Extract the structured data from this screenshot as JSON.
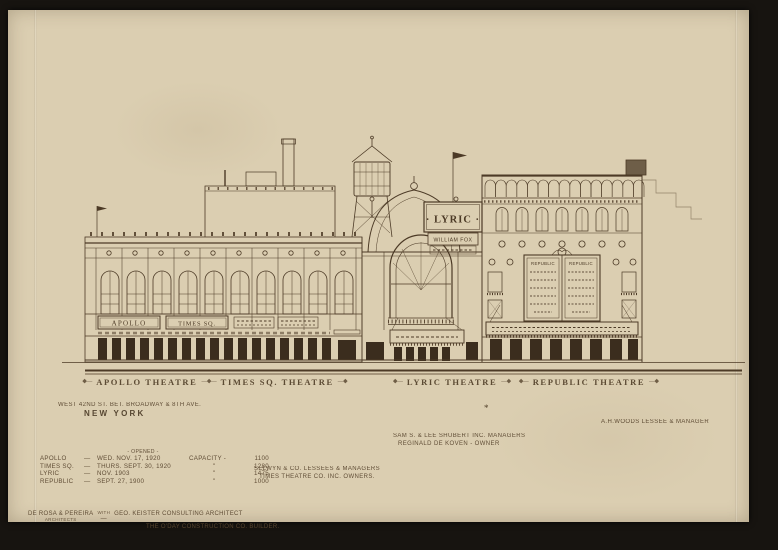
{
  "colors": {
    "paper": "#d8cbad",
    "ink": "#4c3a26",
    "background": "#171410",
    "door_fill": "#3b2d1e"
  },
  "ornaments": {
    "left": "◆—",
    "mid": "—◆—",
    "right": "—◆"
  },
  "building_labels": {
    "apollo": "APOLLO THEATRE",
    "times_sq": "TIMES SQ. THEATRE",
    "lyric": "LYRIC THEATRE",
    "republic": "REPUBLIC THEATRE",
    "asterisk": "*"
  },
  "address": {
    "line1": "WEST 42ND ST. BET. BROADWAY & 8TH AVE.",
    "line2": "NEW YORK"
  },
  "managers": {
    "shubert_line1": "SAM S. & LEE SHUBERT INC. MANAGERS",
    "shubert_line2": "REGINALD DE KOVEN - OWNER",
    "selwyn_line1": "SELWYN & CO. LESSEES & MANAGERS",
    "selwyn_line2": "TIMES THEATRE CO. INC. OWNERS.",
    "woods": "A.H.WOODS LESSEE & MANAGER"
  },
  "stats": {
    "opened_header": "- OPENED -",
    "capacity_label": "CAPACITY -",
    "ditto": "\"",
    "dash": "—",
    "rows": [
      {
        "name": "APOLLO",
        "opened": "WED. NOV. 17, 1920",
        "capacity": "1100"
      },
      {
        "name": "TIMES SQ.",
        "opened": "THURS. SEPT. 30, 1920",
        "capacity": "1280"
      },
      {
        "name": "LYRIC",
        "opened": "NOV. 1903",
        "capacity": "1475"
      },
      {
        "name": "REPUBLIC",
        "opened": "SEPT. 27, 1900",
        "capacity": "1000"
      }
    ]
  },
  "credits": {
    "architects": "DE ROSA & PEREIRA",
    "architects_sub": "ARCHITECTS",
    "with_label": "WITH",
    "dash": "—",
    "consulting": "GEO. KEISTER CONSULTING ARCHITECT",
    "builder": "THE O'DAY CONSTRUCTION CO. BUILDER."
  },
  "signs": {
    "apollo_marquee": "APOLLO",
    "times_marquee": "TIMES SQ.",
    "lyric_board": "· LYRIC ·",
    "lyric_board_sub": "WILLIAM FOX",
    "republic_panel_left": "REPUBLIC",
    "republic_panel_right": "REPUBLIC"
  }
}
